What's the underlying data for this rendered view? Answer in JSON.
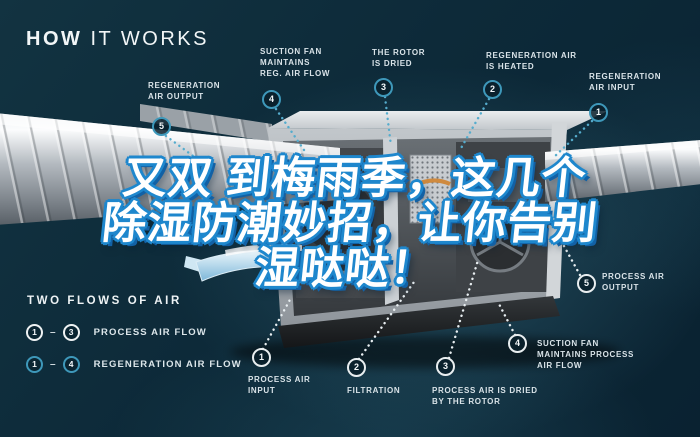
{
  "title": {
    "word_bold": "HOW",
    "word_light": " IT WORKS"
  },
  "overlay": {
    "lines": [
      "又双 到梅雨季，这几个",
      "除湿防潮妙招，让你告别",
      "湿哒哒！"
    ],
    "fill_color": "#ffffff",
    "outline_color": "#1e87cd"
  },
  "callouts": [
    {
      "num": "5",
      "label": "REGENERATION\nAIR OUTPUT",
      "variant": "teal"
    },
    {
      "num": "4",
      "label": "SUCTION FAN\nMAINTAINS\nREG. AIR FLOW",
      "variant": "teal"
    },
    {
      "num": "3",
      "label": "THE ROTOR\nIS DRIED",
      "variant": "teal"
    },
    {
      "num": "2",
      "label": "REGENERATION AIR\nIS HEATED",
      "variant": "teal"
    },
    {
      "num": "1",
      "label": "REGENERATION\nAIR INPUT",
      "variant": "teal"
    },
    {
      "num": "1",
      "label": "PROCESS AIR\nINPUT",
      "variant": "white"
    },
    {
      "num": "2",
      "label": "FILTRATION",
      "variant": "white"
    },
    {
      "num": "3",
      "label": "PROCESS AIR IS DRIED\nBY THE ROTOR",
      "variant": "white"
    },
    {
      "num": "4",
      "label": "SUCTION FAN\nMAINTAINS PROCESS\nAIR FLOW",
      "variant": "white"
    },
    {
      "num": "5",
      "label": "PROCESS AIR\nOUTPUT",
      "variant": "white"
    }
  ],
  "legend": {
    "title": "TWO FLOWS OF AIR",
    "rows": [
      {
        "from": "1",
        "to": "3",
        "label": "PROCESS AIR FLOW",
        "variant": "white"
      },
      {
        "from": "1",
        "to": "4",
        "label": "REGENERATION AIR FLOW",
        "variant": "teal"
      }
    ]
  },
  "colors": {
    "background": "#0d2a39",
    "accent_teal": "#3e98ba",
    "label_text": "#d9e3e8",
    "badge_white_border": "#e9eef0",
    "chinese_outline": "#1e87cd",
    "heater_orange": "#cf8a3f"
  }
}
